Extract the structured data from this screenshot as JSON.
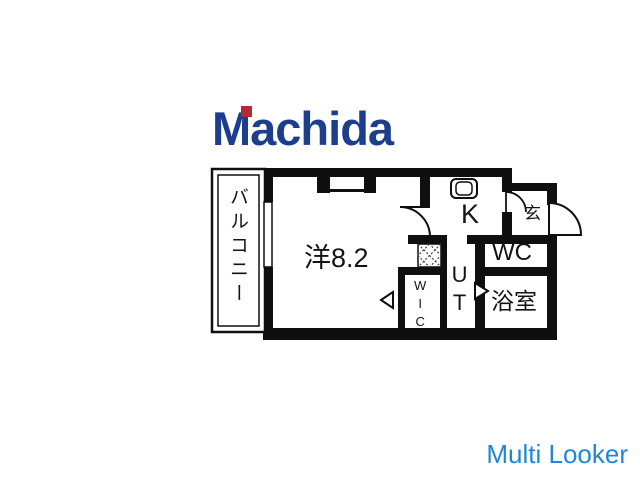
{
  "page": {
    "background_color": "#ffffff"
  },
  "branding": {
    "logo_text": "Machida",
    "logo_color": "#1d3e8d",
    "logo_accent_color": "#b22a3a",
    "watermark_text": "Multi Looker",
    "watermark_color": "#1f87d9"
  },
  "floorplan": {
    "wall_color": "#0f0f0f",
    "labels": {
      "balcony": "バルコニー",
      "main_room": "洋8.2",
      "kitchen": "K",
      "entrance": "玄",
      "toilet": "WC",
      "bathroom": "浴室",
      "utility": "UT",
      "closet": "WIC"
    }
  }
}
